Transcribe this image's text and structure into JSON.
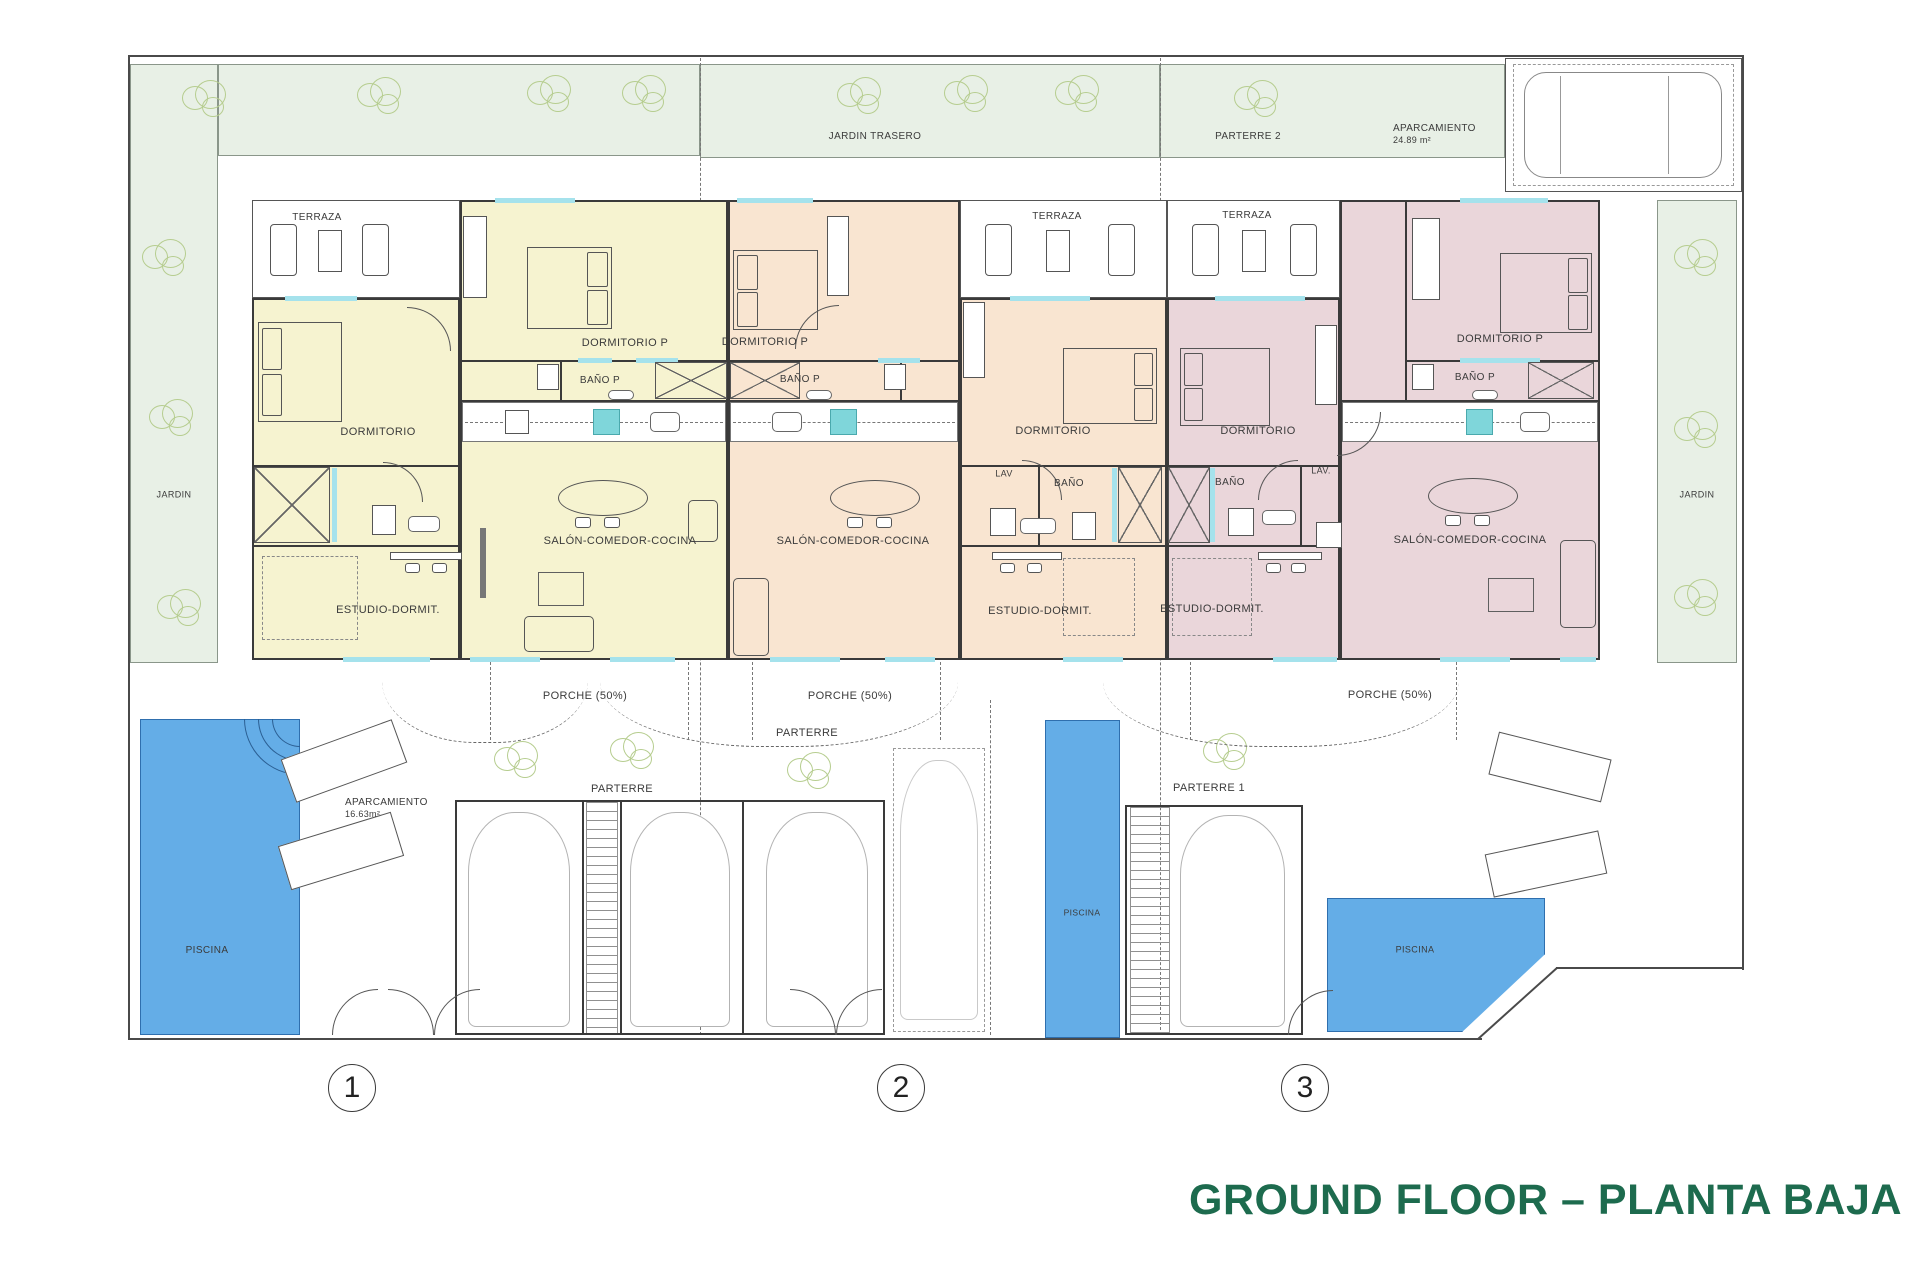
{
  "title": "GROUND FLOOR – PLANTA BAJA",
  "accent_color": "#1d6b4e",
  "site": {
    "jardin_left": "JARDIN",
    "jardin_right": "JARDIN",
    "jardin_trasero": "JARDIN TRASERO",
    "parterre_2": "PARTERRE 2",
    "parterre_center": "PARTERRE",
    "parterre_left": "PARTERRE",
    "parterre_1": "PARTERRE 1",
    "piscina_1": "PISCINA",
    "piscina_2": "PISCINA",
    "piscina_3": "PISCINA",
    "aparcamiento_top": {
      "label": "APARCAMIENTO",
      "area": "24.89 m²"
    },
    "aparcamiento_1": {
      "label": "APARCAMIENTO",
      "area": "16.63m²"
    }
  },
  "unit1": {
    "number": "1",
    "terraza": "TERRAZA",
    "dormitorio": "DORMITORIO",
    "dormitorio_p": "DORMITORIO P",
    "bano_p": "BAÑO P",
    "salon": "SALÓN-COMEDOR-COCINA",
    "estudio": "ESTUDIO-DORMIT.",
    "porche": "PORCHE (50%)"
  },
  "unit2": {
    "number": "2",
    "terraza": "TERRAZA",
    "dormitorio": "DORMITORIO",
    "dormitorio_p": "DORMITORIO P",
    "bano_p": "BAÑO P",
    "bano": "BAÑO",
    "lav": "LAV",
    "salon": "SALÓN-COMEDOR-COCINA",
    "estudio": "ESTUDIO-DORMIT.",
    "porche": "PORCHE (50%)"
  },
  "unit3": {
    "number": "3",
    "terraza": "TERRAZA",
    "dormitorio": "DORMITORIO",
    "dormitorio_p": "DORMITORIO P",
    "bano_p": "BAÑO P",
    "bano": "BAÑO",
    "lav": "LAV.",
    "salon": "SALÓN-COMEDOR-COCINA",
    "estudio": "ESTUDIO-DORMIT.",
    "porche": "PORCHE (50%)"
  }
}
